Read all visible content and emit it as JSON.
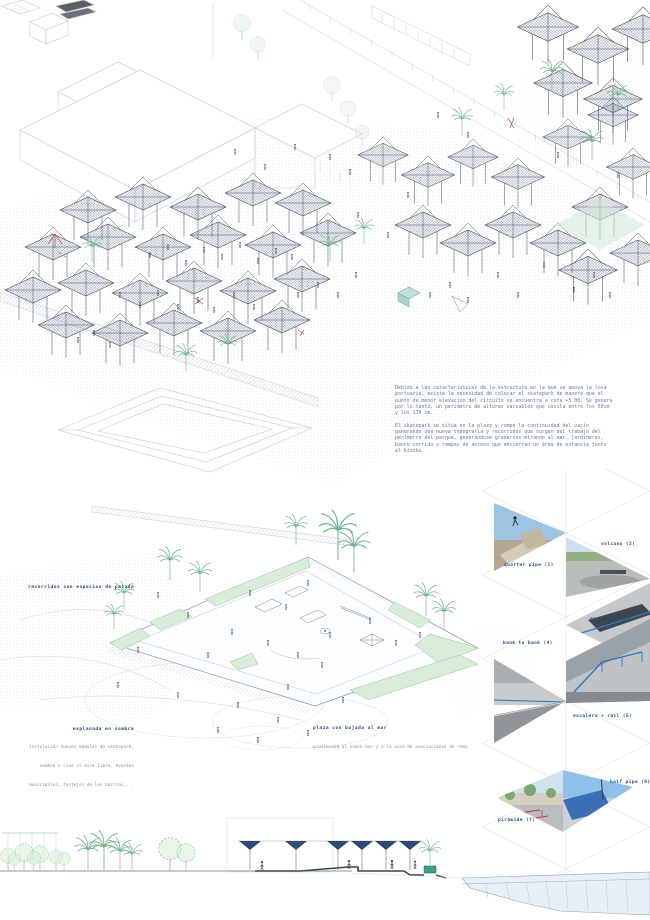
{
  "board": {
    "description": {
      "p1": "Debido a las características de la estructura en la que se apoya la losa portuaria, existe la necesidad de colocar el skatepark de manera que el punto de menor elevación del circuito se encuentra a cota +5.00. Se genera por lo tanto, un perímetro de alturas variables que oscila entre los 50cm y los 170 cm.",
      "p2": "El skatepark se sitúa en la plaza y rompe la continuidad del vacío generando una nueva topografía y recorridos que surgen del trabajo del perímetro del parque, generándose graderíos mirando al mar, jardineras, banco corrido y rampas de acceso que encierran un área de estancia junto al kiosko."
    },
    "plan_labels": {
      "routes": "recorridos con espacios de parada",
      "esplanade_title": "explanada en sombra",
      "esplanade_caption": "instalación nuevos módulos de skatepark, sombra o cine al aire libre, eventos municipales, festejos de los barrios,...",
      "plaza_title": "plaza con bajada al mar",
      "plaza_caption": "proximidad al snack-bar y a la zona de asociaciones de remo"
    },
    "photos": [
      {
        "label": "quarter pipe (1)"
      },
      {
        "label": "volcano (2)"
      },
      {
        "label": "manualera (3)"
      },
      {
        "label": "bank to bank (4)"
      },
      {
        "label": "escalera + rail (5)"
      },
      {
        "label": "half pipe (6)"
      },
      {
        "label": "pirámide (7)"
      }
    ],
    "palette": {
      "label_navy": "#24497a",
      "text_blue": "#64789a",
      "line_light": "#c6cdd6",
      "ink": "#46566b",
      "green_palm": "#6fb187",
      "green_fill": "#d9ecd9",
      "red_accent": "#c0443a",
      "canopy_dark": "#2d4b73",
      "teal": "#3aa387",
      "pier_fill": "#e8eef6",
      "pier_line": "#8aa3c4"
    }
  }
}
